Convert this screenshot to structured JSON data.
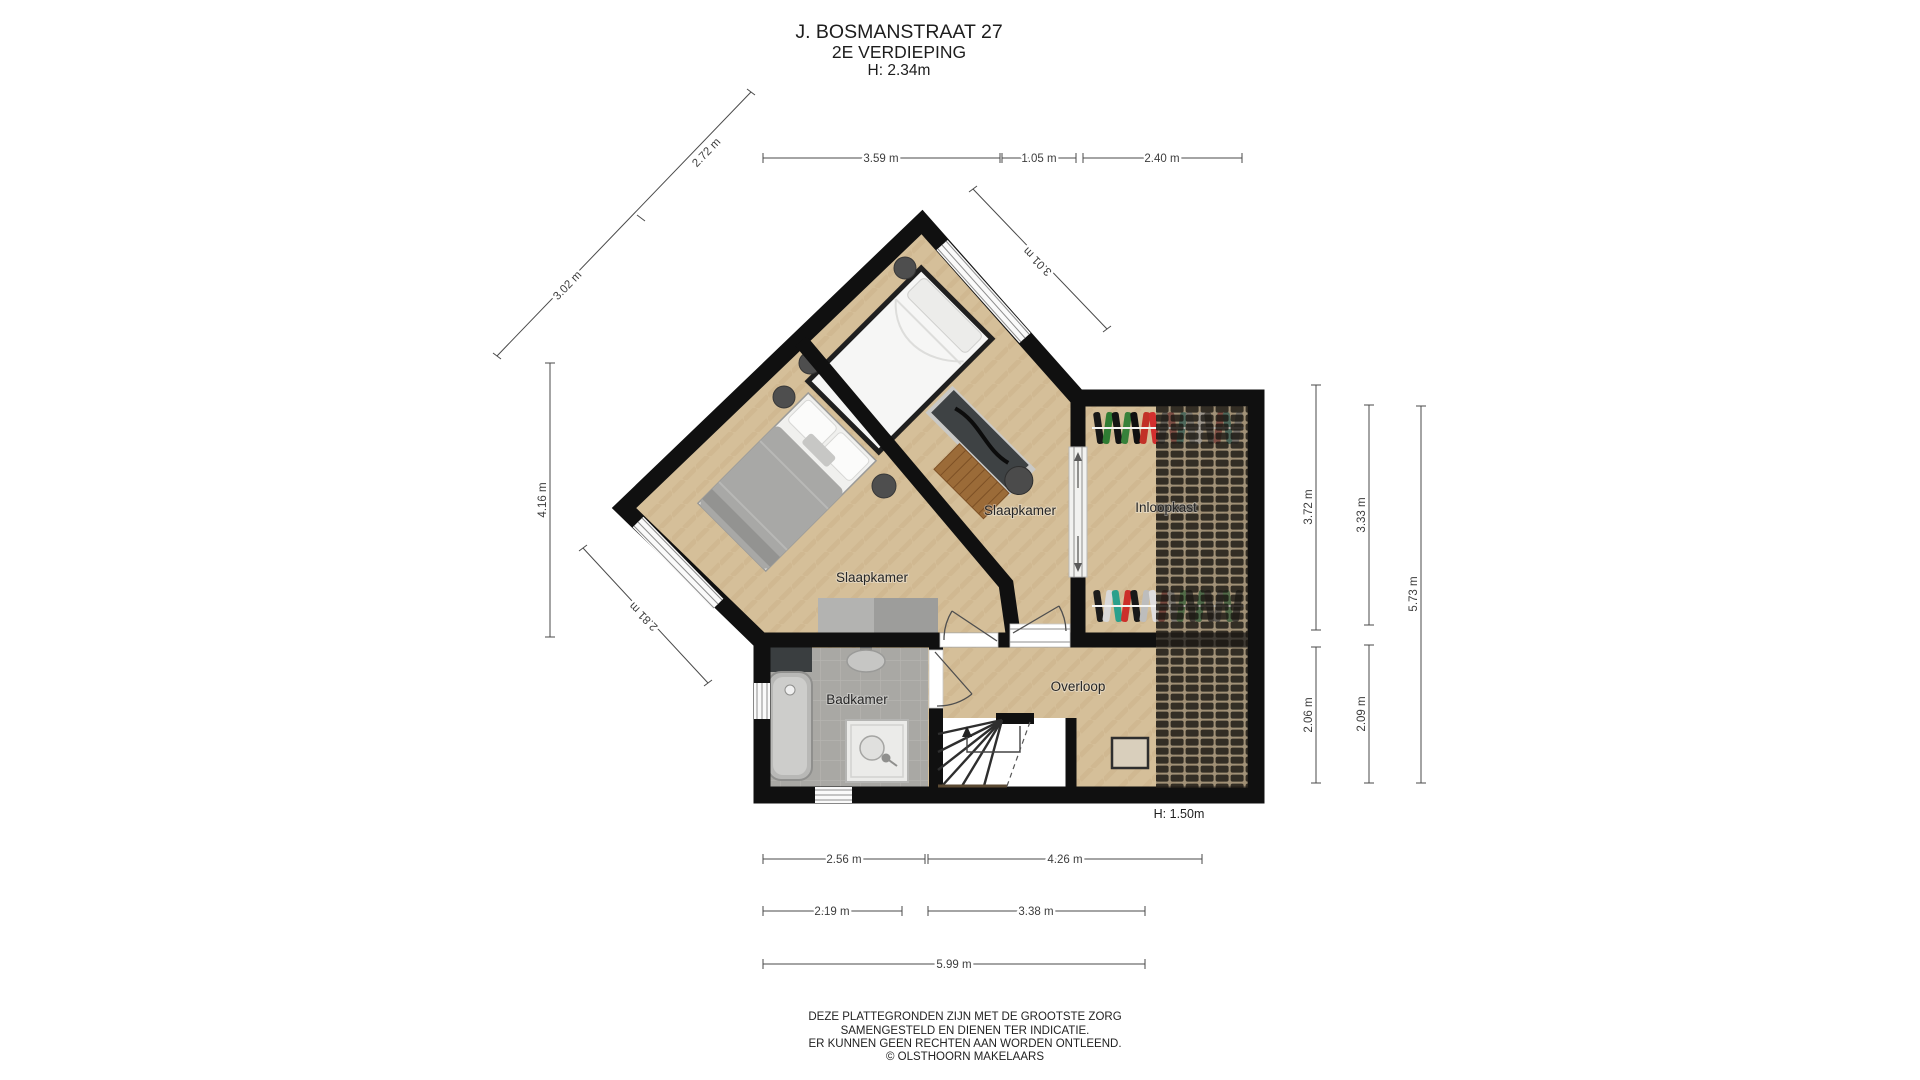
{
  "title": {
    "address": "J. BOSMANSTRAAT 27",
    "floor": "2E VERDIEPING",
    "height": "H: 2.34m"
  },
  "rooms": {
    "slaapkamer_left": "Slaapkamer",
    "slaapkamer_right": "Slaapkamer",
    "inloopkast": "Inloopkast",
    "badkamer": "Badkamer",
    "overloop": "Overloop"
  },
  "annotations": {
    "low_height": "H: 1.50m"
  },
  "dimensions": {
    "top": [
      "3.59 m",
      "1.05 m",
      "2.40 m"
    ],
    "diagonal_upper_left": [
      "3.02 m",
      "2.72 m"
    ],
    "diagonal_upper_right": [
      "3.01 m"
    ],
    "diagonal_lower_left": [
      "2.81 m"
    ],
    "left_vertical": [
      "4.16 m"
    ],
    "right_vertical": [
      "3.72 m",
      "3.33 m",
      "5.73 m",
      "2.06 m",
      "2.09 m"
    ],
    "bottom": [
      "2.56 m",
      "4.26 m",
      "2.19 m",
      "3.38 m",
      "5.99 m"
    ]
  },
  "footer": [
    "DEZE PLATTEGRONDEN ZIJN MET DE GROOTSTE ZORG",
    "SAMENGESTELD EN DIENEN TER INDICATIE.",
    "ER KUNNEN GEEN RECHTEN AAN WORDEN ONTLEEND.",
    "© OLSTHOORN MAKELAARS"
  ],
  "inloopkast_racks": {
    "top_colors": [
      "#181818",
      "#2f7c33",
      "#141414",
      "#37813a",
      "#101010",
      "#c23128",
      "#d32f2f",
      "#565656",
      "#8c3a34",
      "#2f6e62",
      "#8a8a8a",
      "#c8c6c2",
      "#3a3a3a",
      "#913a35",
      "#2c6b5f",
      "#777777"
    ],
    "bottom_colors": [
      "#1c1c1c",
      "#d9d9d9",
      "#2aa08c",
      "#cc2f2a",
      "#191919",
      "#bdbdbd",
      "#e0dede",
      "#7c2a24",
      "#8d8d8d",
      "#347538",
      "#1f1f1f",
      "#2f6e3c",
      "#242424",
      "#575757",
      "#346e3a",
      "#1d1d1d"
    ]
  },
  "colors": {
    "floor_wood": "#d5bf99",
    "wall": "#101010",
    "bathroom_floor": "#a9a8a4",
    "roof_hatch_tile": "#181510",
    "dimension_text": "#3d3d3d"
  }
}
